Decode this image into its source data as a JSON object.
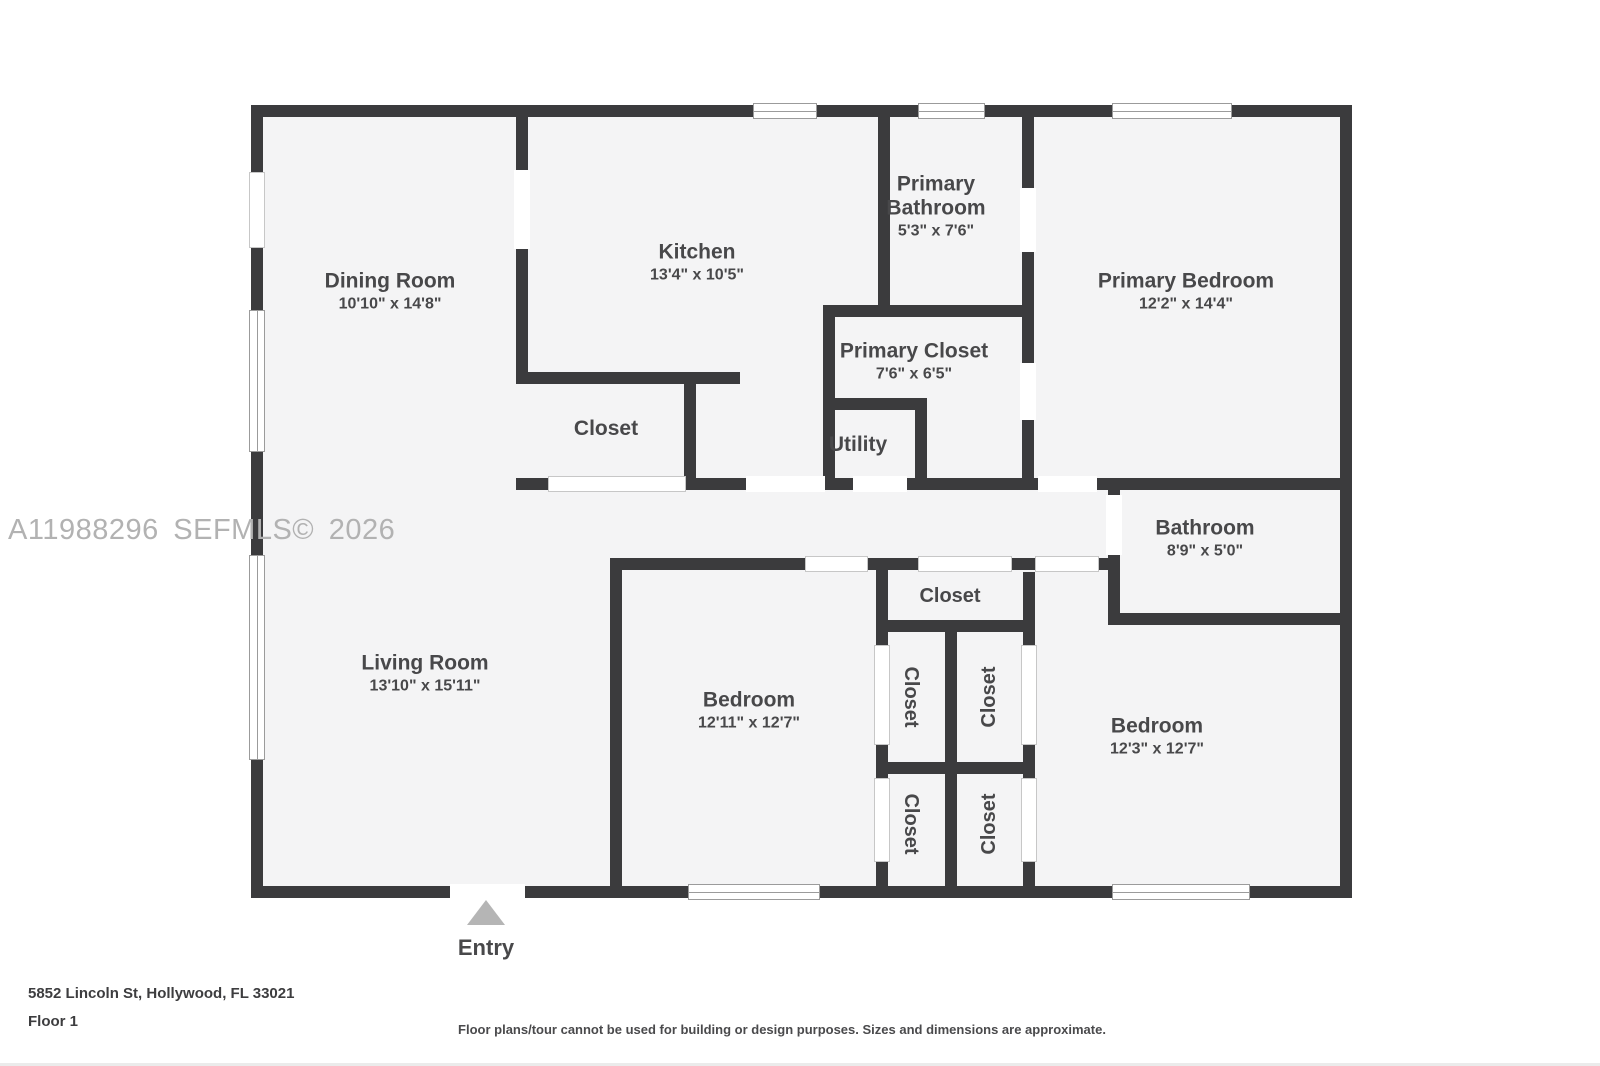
{
  "watermark": "A11988296 SEFMLS© 2026",
  "entry": {
    "label": "Entry"
  },
  "rooms": {
    "dining": {
      "name": "Dining Room",
      "dims": "10'10\" x 14'8\""
    },
    "kitchen": {
      "name": "Kitchen",
      "dims": "13'4\" x 10'5\""
    },
    "primary_bathroom": {
      "name": "Primary Bathroom",
      "dims": "5'3\" x 7'6\""
    },
    "primary_bedroom": {
      "name": "Primary Bedroom",
      "dims": "12'2\" x 14'4\""
    },
    "primary_closet": {
      "name": "Primary Closet",
      "dims": "7'6\" x 6'5\""
    },
    "utility": {
      "name": "Utility"
    },
    "closet_hall": {
      "name": "Closet"
    },
    "bathroom": {
      "name": "Bathroom",
      "dims": "8'9\" x 5'0\""
    },
    "living": {
      "name": "Living Room",
      "dims": "13'10\" x 15'11\""
    },
    "bedroom2": {
      "name": "Bedroom",
      "dims": "12'11\" x 12'7\""
    },
    "bedroom3": {
      "name": "Bedroom",
      "dims": "12'3\" x 12'7\""
    },
    "closet_top": {
      "name": "Closet"
    },
    "closet_ul": {
      "name": "Closet"
    },
    "closet_ur": {
      "name": "Closet"
    },
    "closet_ll": {
      "name": "Closet"
    },
    "closet_lr": {
      "name": "Closet"
    }
  },
  "footer": {
    "address": "5852 Lincoln St, Hollywood, FL 33021",
    "floor": "Floor 1",
    "disclaimer": "Floor plans/tour cannot be used for building or design purposes. Sizes and dimensions are approximate."
  },
  "colors": {
    "wall": "#3b3b3d",
    "floor": "#f4f4f5",
    "label_text": "#48484a",
    "watermark_text": "#b2b2b2",
    "entry_arrow": "#b5b5b5"
  }
}
